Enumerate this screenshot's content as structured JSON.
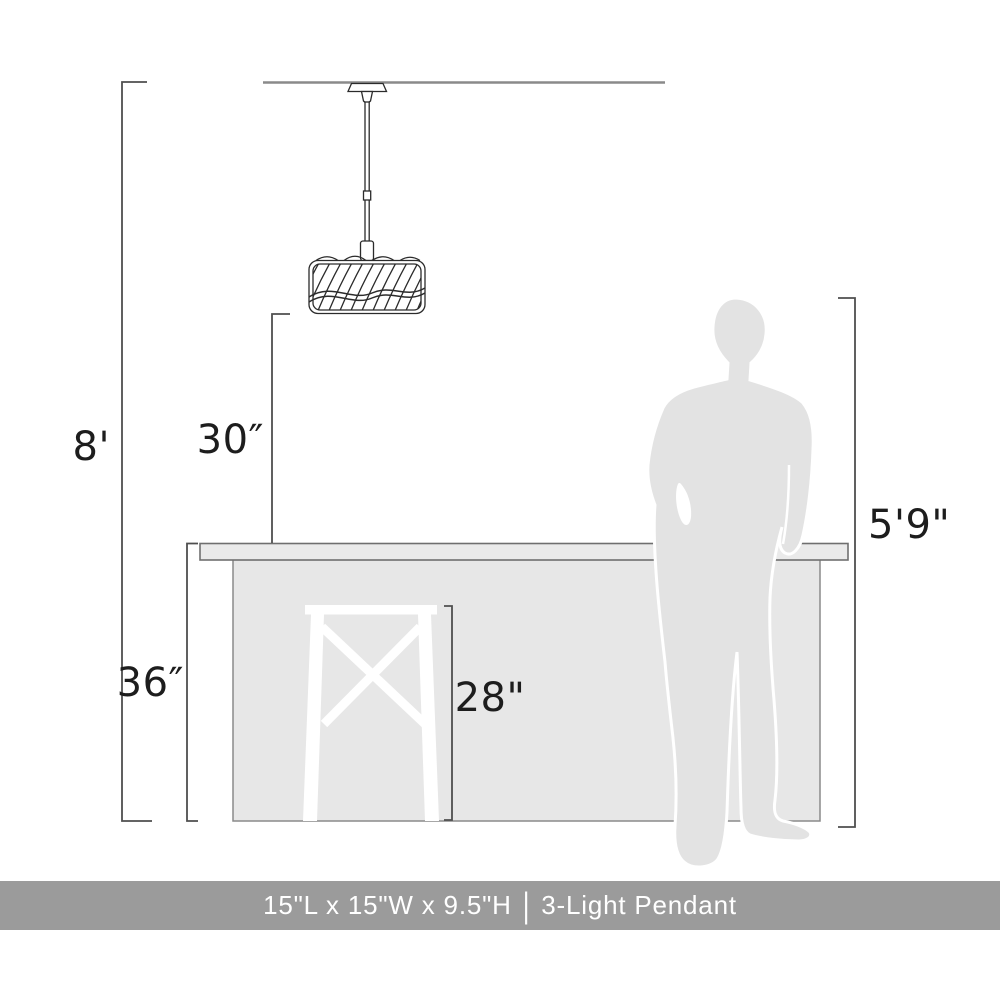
{
  "colors": {
    "dimension_line": "#4f4f4f",
    "label_text": "#1d1d1d",
    "drawing_outline": "#2b2b2b",
    "ceiling_line": "#8a8a8a",
    "counter_outline": "#8a8a8a",
    "countertop_outline": "#6f6f6f",
    "counter_fill": "#e7e7e7",
    "countertop_fill": "#eaeaea",
    "silhouette_fill": "#e3e3e3",
    "stool_fill": "#ffffff",
    "caption_bar": "#9b9b9b",
    "caption_text": "#ffffff"
  },
  "dimensions": {
    "ceiling_height": "8'",
    "pendant_bottom_to_counter": "30″",
    "counter_height": "36″",
    "stool_height": "28\"",
    "person_height": "5'9\""
  },
  "caption": {
    "size": "15\"L x 15\"W x 9.5\"H",
    "divider": "|",
    "name": "3-Light Pendant"
  }
}
